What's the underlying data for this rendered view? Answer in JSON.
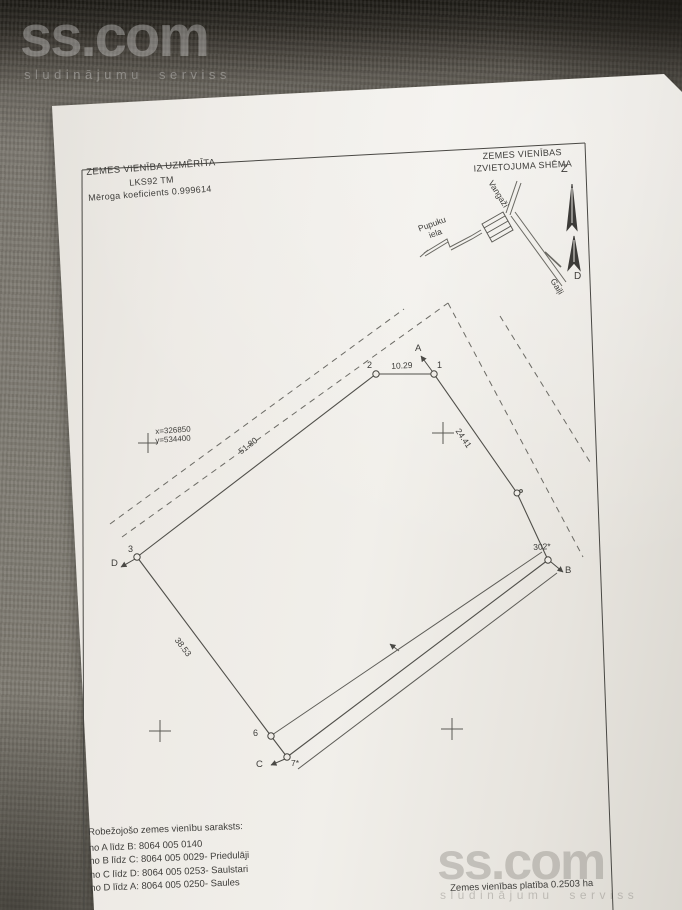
{
  "watermarks": {
    "top": {
      "brand": "ss.com",
      "tagline": "sludinājumu serviss"
    },
    "bottom": {
      "brand": "ss.com",
      "tagline": "sludinājumu serviss"
    }
  },
  "survey_header": {
    "title": "ZEMES VIENĪBA UZMĒRĪTA",
    "system": "LKS92 TM",
    "scale_note": "Mēroga koeficients 0.999614"
  },
  "location_schema": {
    "title_line1": "ZEMES VIENĪBAS",
    "title_line2": "IZVIETOJUMA SHĒMA",
    "north_label": "Z",
    "south_label": "D",
    "road_vangazi": "Vangaži",
    "road_pupuku_line1": "Pupuku",
    "road_pupuku_line2": "iela",
    "road_gaili": "Gaiļi"
  },
  "plan": {
    "coord_x": "x=326850",
    "coord_y": "y=534400",
    "corner_a": "A",
    "corner_b": "B",
    "corner_c": "C",
    "corner_d": "D",
    "point_1": "1",
    "point_2": "2",
    "point_3": "3",
    "point_6": "6",
    "point_7": "7*",
    "point_302": "302*",
    "dist_2_1": "10.29",
    "dist_1_b": "24.41",
    "dist_3_2": "51.80",
    "dist_6_3": "38.53"
  },
  "footer": {
    "list_title": "Robežojošo zemes vienību saraksts:",
    "boundaries": [
      "no A līdz B: 8064 005 0140",
      "no B līdz C: 8064 005 0029- Priedulāji",
      "no C līdz D: 8064 005 0253- Saulstari",
      "no D līdz A: 8064 005 0250- Saules"
    ],
    "area_note": "Zemes vienības platība 0.2503 ha"
  }
}
